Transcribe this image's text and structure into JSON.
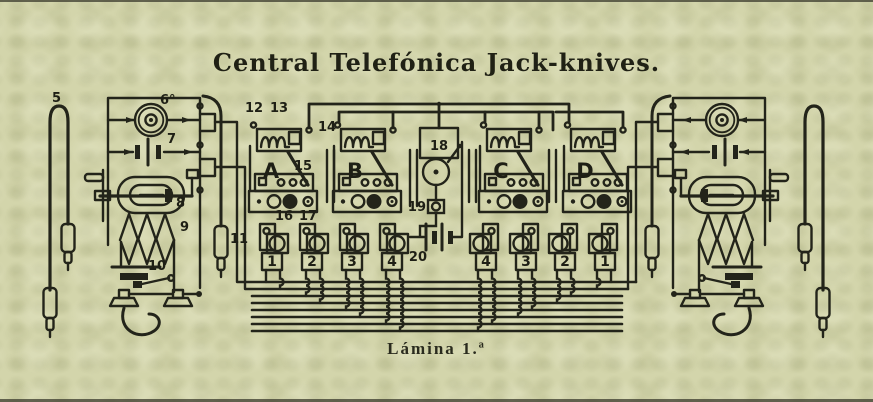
{
  "title": "Central Telefónica Jack-knives.",
  "caption": "Lámina 1.ª",
  "colors": {
    "paper": "#d3d5ab",
    "ink": "#23241a"
  },
  "labels": {
    "p5": "5",
    "p6": "6°",
    "p7": "7",
    "p8": "8",
    "p9": "9",
    "p10": "10",
    "p11": "11",
    "p12": "12",
    "p13": "13",
    "p14": "14",
    "p15": "15",
    "p16": "16",
    "p17": "17",
    "p18": "18",
    "p19": "19",
    "p20": "20"
  },
  "jacks": [
    {
      "label": "A"
    },
    {
      "label": "B"
    },
    {
      "label": "C"
    },
    {
      "label": "D"
    }
  ],
  "plug_rows": {
    "left": [
      "1",
      "2",
      "3",
      "4"
    ],
    "right": [
      "4",
      "3",
      "2",
      "1"
    ]
  }
}
